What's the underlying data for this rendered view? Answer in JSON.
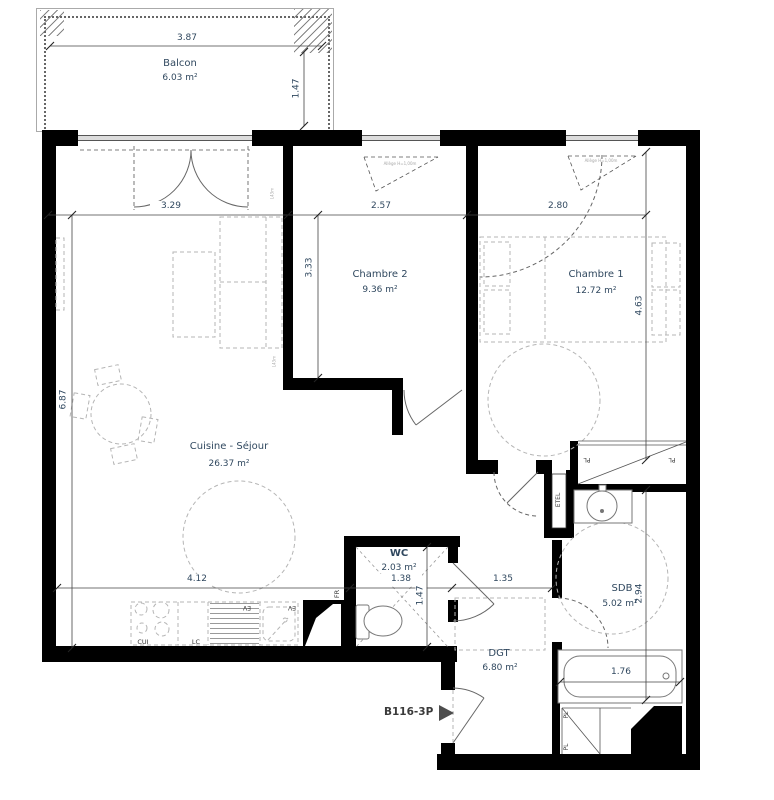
{
  "plan": {
    "unit": {
      "label": "B116-3P"
    },
    "rooms": {
      "balcon": {
        "name": "Balcon",
        "area": "6.03 m²"
      },
      "chambre2": {
        "name": "Chambre 2",
        "area": "9.36 m²"
      },
      "chambre1": {
        "name": "Chambre 1",
        "area": "12.72 m²"
      },
      "sejour": {
        "name": "Cuisine - Séjour",
        "area": "26.37 m²"
      },
      "wc": {
        "name": "WC",
        "area": "2.03 m²"
      },
      "sdb": {
        "name": "SDB",
        "area": "5.02 m²"
      },
      "dgt": {
        "name": "DGT",
        "area": "6.80 m²"
      }
    },
    "dims": {
      "balcony_width": "3.87",
      "balcony_depth": "1.47",
      "sejour_window": "3.29",
      "chambre2_width": "2.57",
      "chambre1_width": "2.80",
      "sejour_height": "6.87",
      "chambre2_height": "3.33",
      "chambre1_height": "4.63",
      "sdb_height": "2.94",
      "kitchen_width": "4.12",
      "wc_width": "1.38",
      "wc_height": "1.47",
      "hall_width": "1.35",
      "bath_width": "1.76"
    },
    "fixtures": {
      "stove": "CUI",
      "lc": "LC",
      "sink1": "EV",
      "sink2": "EV",
      "fridge": "FR",
      "etel": "ETEL",
      "pl1": "PL",
      "pl2": "PL",
      "pl3": "PL",
      "pl4": "PL"
    },
    "notes": {
      "window1": "Allège H=1,00m",
      "window2": "Allège H=1,00m",
      "wall1": "L43m",
      "wall2": "L43m"
    },
    "colors": {
      "wall": "#000000",
      "dim_text": "#30485f",
      "furniture": "#b5b5b5"
    }
  }
}
